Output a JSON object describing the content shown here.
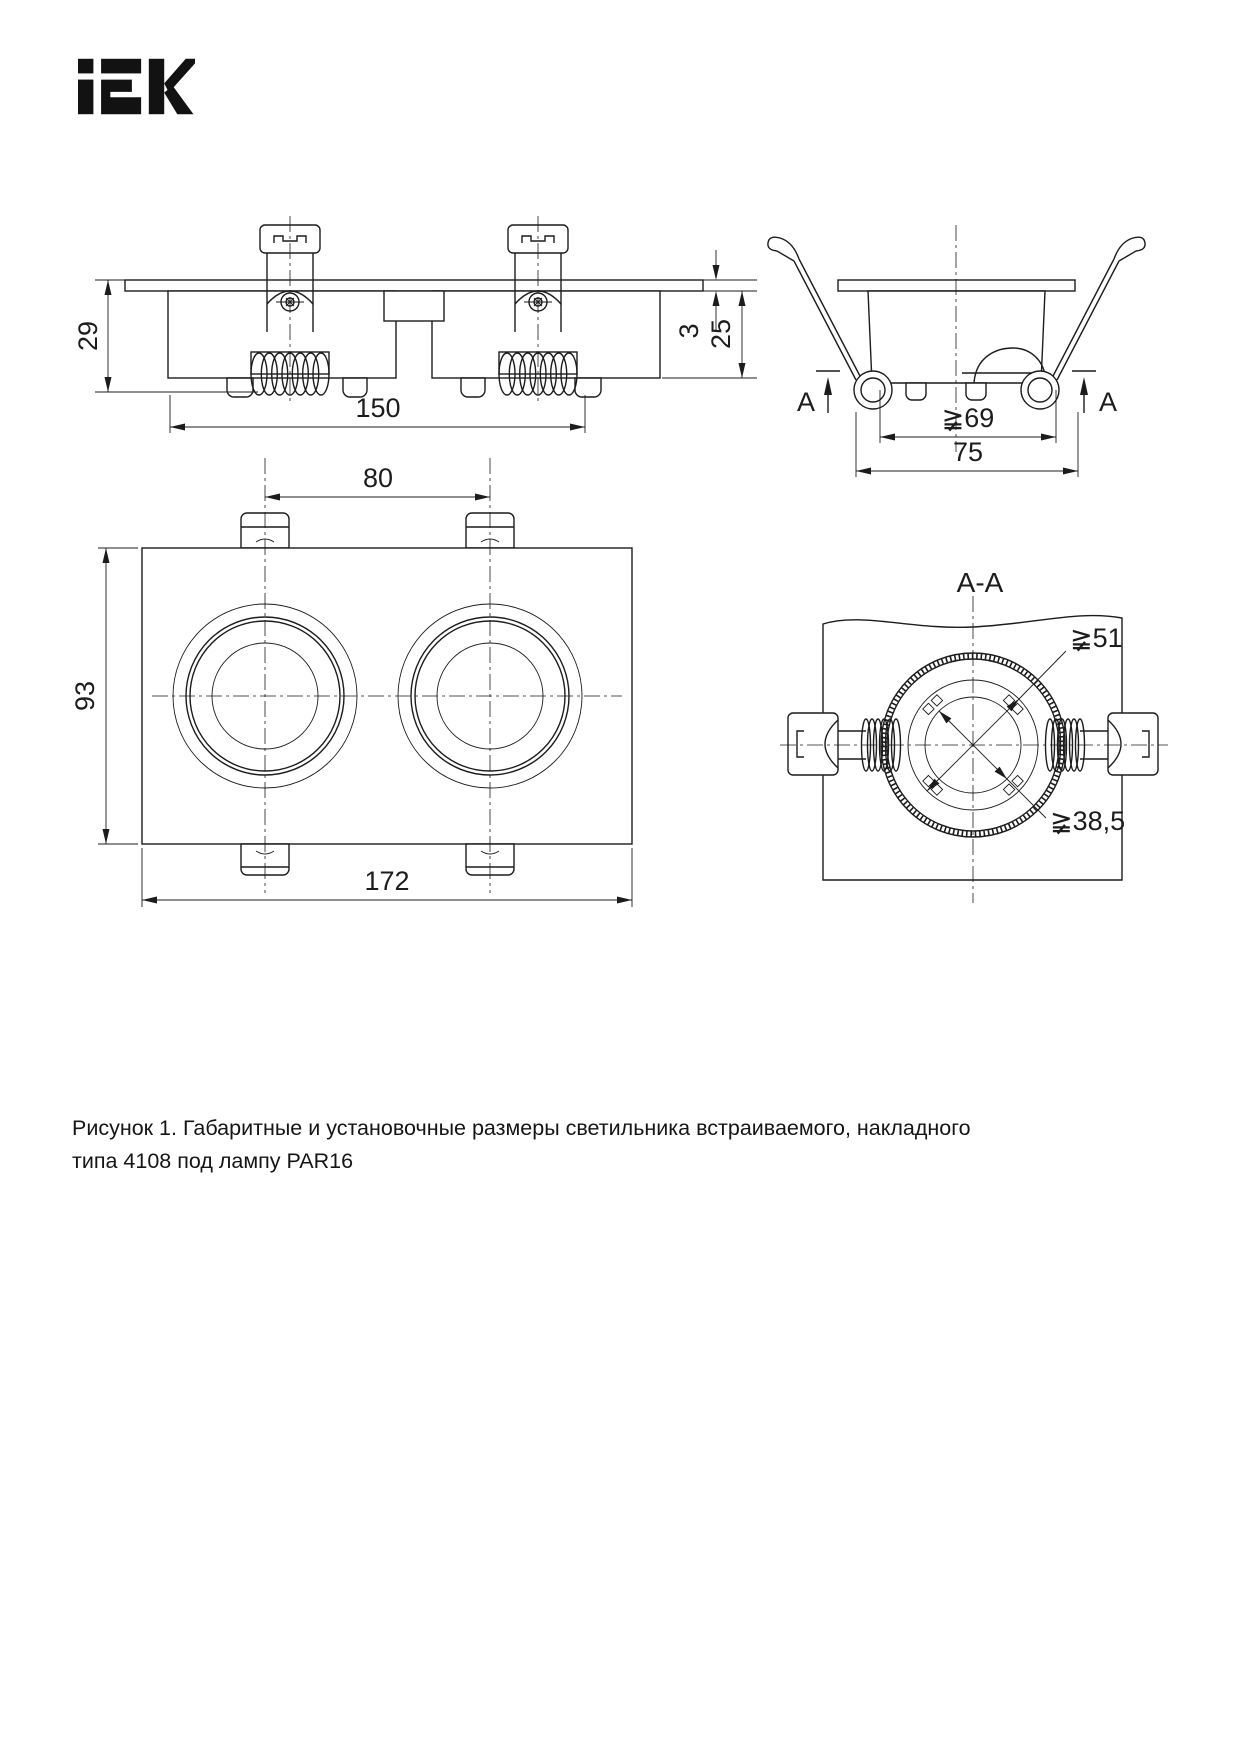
{
  "page": {
    "background": "#ffffff",
    "line_color": "#1c1c1c"
  },
  "logo": {
    "text": "iEK"
  },
  "figure": {
    "views": {
      "front_view": {
        "label": "front view",
        "dims": {
          "body_height": "29",
          "mounting_span": "150",
          "plate_thickness": "3",
          "recess_depth": "25"
        }
      },
      "side_view": {
        "label": "side view",
        "section_marker": "A",
        "dims": {
          "hole_diameter": "≩69",
          "outer_width": "75"
        }
      },
      "plan_view": {
        "label": "top view",
        "dims": {
          "center_spacing": "80",
          "body_width": "93",
          "body_length": "172"
        }
      },
      "section_view": {
        "title": "A-A",
        "dims": {
          "ring_diameter": "≩51",
          "inner_diameter": "≩38,5"
        }
      }
    },
    "caption_line1": "Рисунок 1. Габаритные и установочные размеры светильника встраиваемого, накладного",
    "caption_line2": "типа 4108 под лампу PAR16"
  }
}
